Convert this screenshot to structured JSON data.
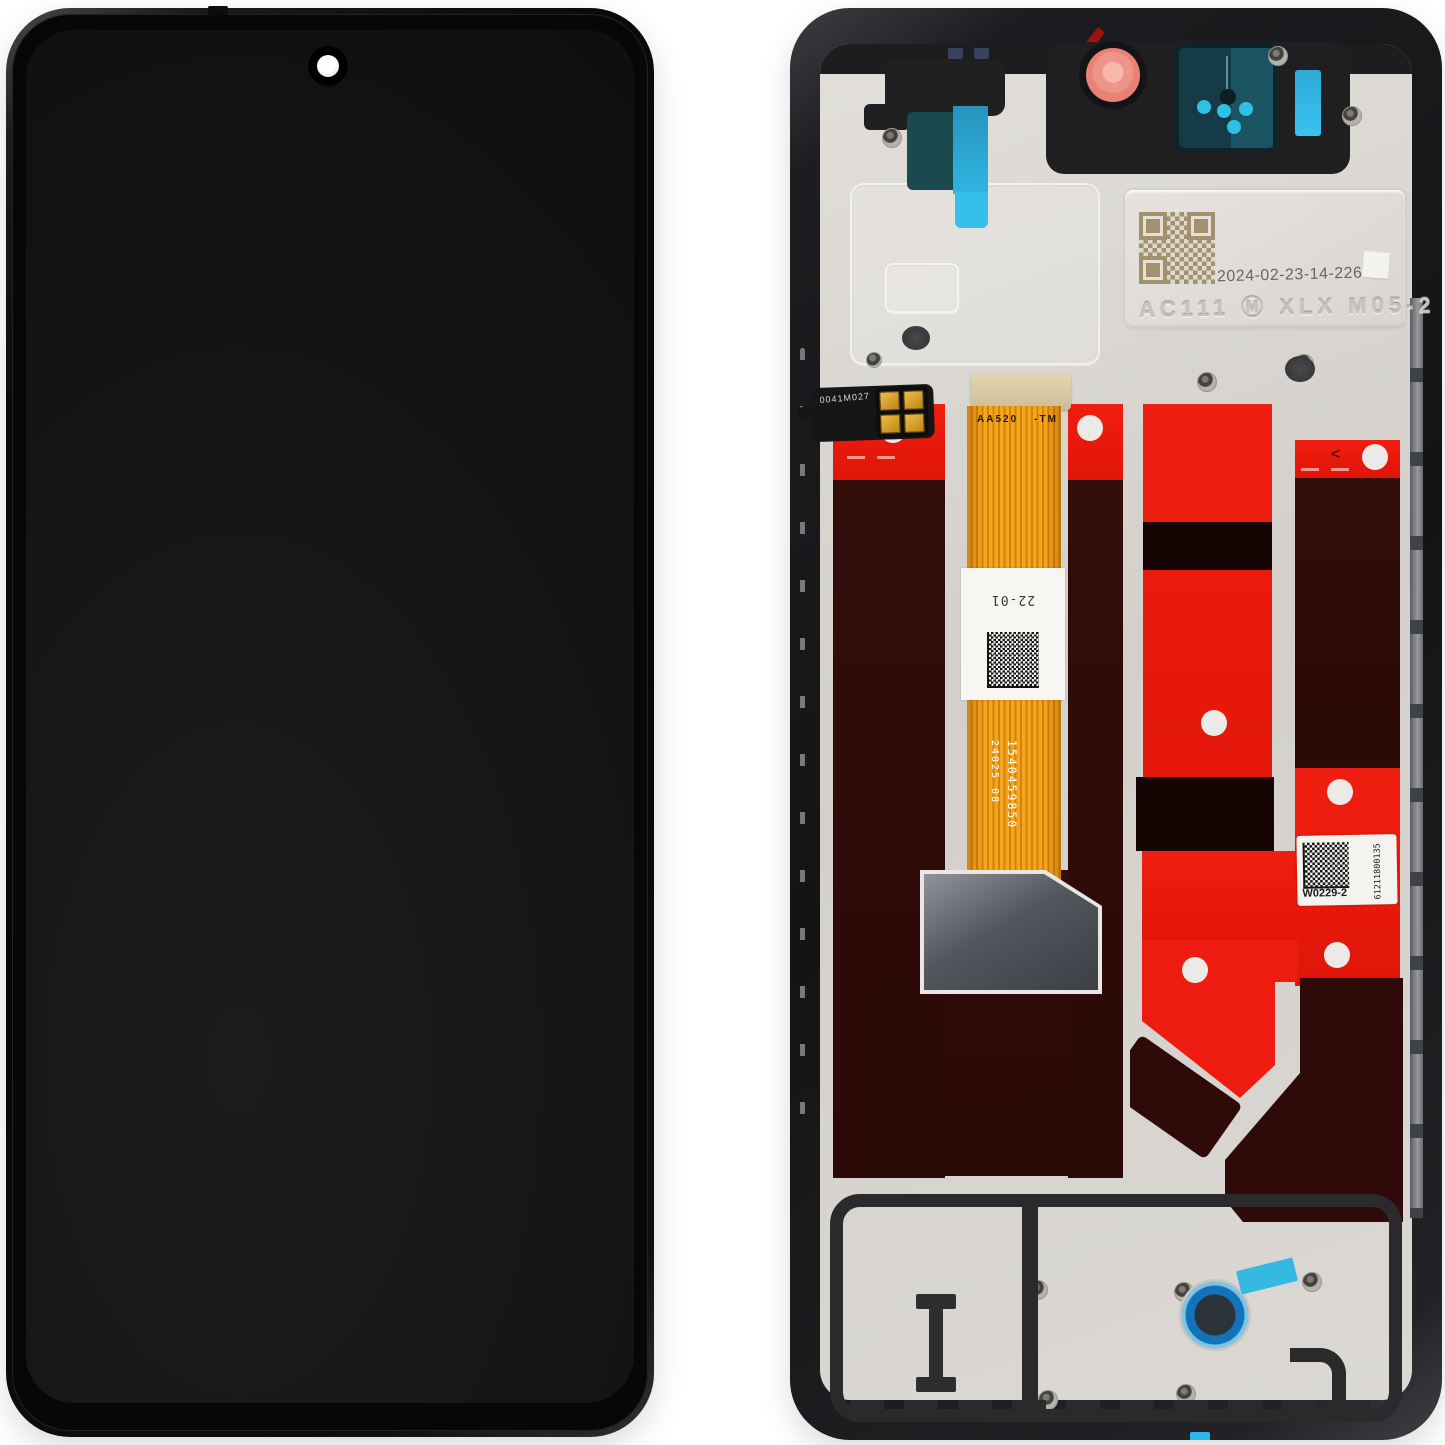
{
  "page": {
    "description": "Phone LCD display assembly spare part, front glass view (left) and rear frame view (right)"
  },
  "colors": {
    "bg": "#ffffff",
    "frame_black": "#1b1b1d",
    "metal": "#d3d0cb",
    "metal_light": "#e2dfda",
    "adhesive_red": "#f01e10",
    "adhesive_dark": "#2a0907",
    "flex_orange": "#f6a51e",
    "flex_stripe": "#d3820a",
    "connector_tan": "#cdbd97",
    "connector_gray": "#53575c",
    "sticker_teal": "#1b4a4e",
    "sticker_cyan": "#2fb5e2",
    "gasket_pink": "#ef9488",
    "cam_dot_cyan": "#2fc0e8",
    "ring_blue": "#1273ba",
    "screen_black": "#151515",
    "qr_tan": "#a2916c"
  },
  "back": {
    "qr_plate": {
      "date_code": "2024-02-23-14-226",
      "embossed_code": "AC111 Ⓜ XLX M05-2"
    },
    "main_flex": {
      "connector_code": "AA520",
      "connector_suffix": "-TM",
      "label_code": "22-01",
      "serial": "1540459850",
      "batch": "24025  08"
    },
    "warranty_sticker": {
      "code": "W0229-2",
      "serial": "61211800135"
    },
    "sensor_flex": {
      "code": "0041M027"
    },
    "adhesive": {
      "arrow_mark": "<"
    }
  }
}
